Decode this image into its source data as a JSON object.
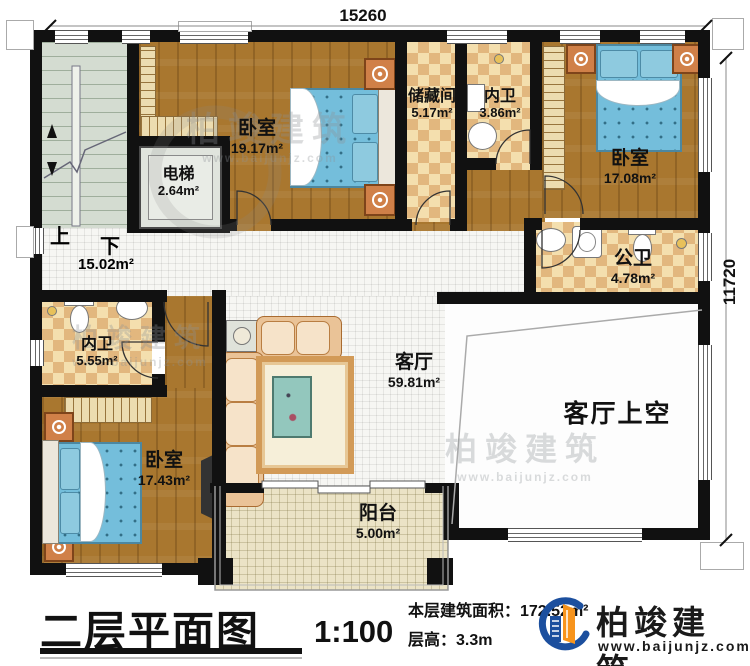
{
  "plan": {
    "dimensions": {
      "top": "15260",
      "right": "11720"
    },
    "stairs": {
      "up": "上",
      "down": "下",
      "area": "15.02m²"
    },
    "rooms": {
      "bedroom_top": {
        "name": "卧室",
        "area": "19.17m²"
      },
      "storage": {
        "name": "储藏间",
        "area": "5.17m²"
      },
      "bath_top": {
        "name": "内卫",
        "area": "3.86m²"
      },
      "bedroom_right": {
        "name": "卧室",
        "area": "17.08m²"
      },
      "elevator": {
        "name": "电梯",
        "area": "2.64m²"
      },
      "bath_public": {
        "name": "公卫",
        "area": "4.78m²"
      },
      "bath_left": {
        "name": "内卫",
        "area": "5.55m²"
      },
      "bedroom_bottom": {
        "name": "卧室",
        "area": "17.43m²"
      },
      "living": {
        "name": "客厅",
        "area": "59.81m²"
      },
      "living_void": {
        "name": "客厅上空"
      },
      "balcony": {
        "name": "阳台",
        "area": "5.00m²"
      }
    }
  },
  "title_block": {
    "title": "二层平面图",
    "scale": "1:100",
    "area_line": "本层建筑面积：172.52m²",
    "height_line": "层高：3.3m"
  },
  "brand": {
    "name": "柏竣建筑",
    "website": "www.baijunjz.com"
  },
  "watermark": {
    "name": "柏竣建筑",
    "website": "www.baijunjz.com"
  },
  "colors": {
    "wall": "#111111",
    "wood": "#a9772f",
    "bed": "#74bedb",
    "brand_blue": "#1c4f9e",
    "brand_orange": "#f7941d"
  }
}
